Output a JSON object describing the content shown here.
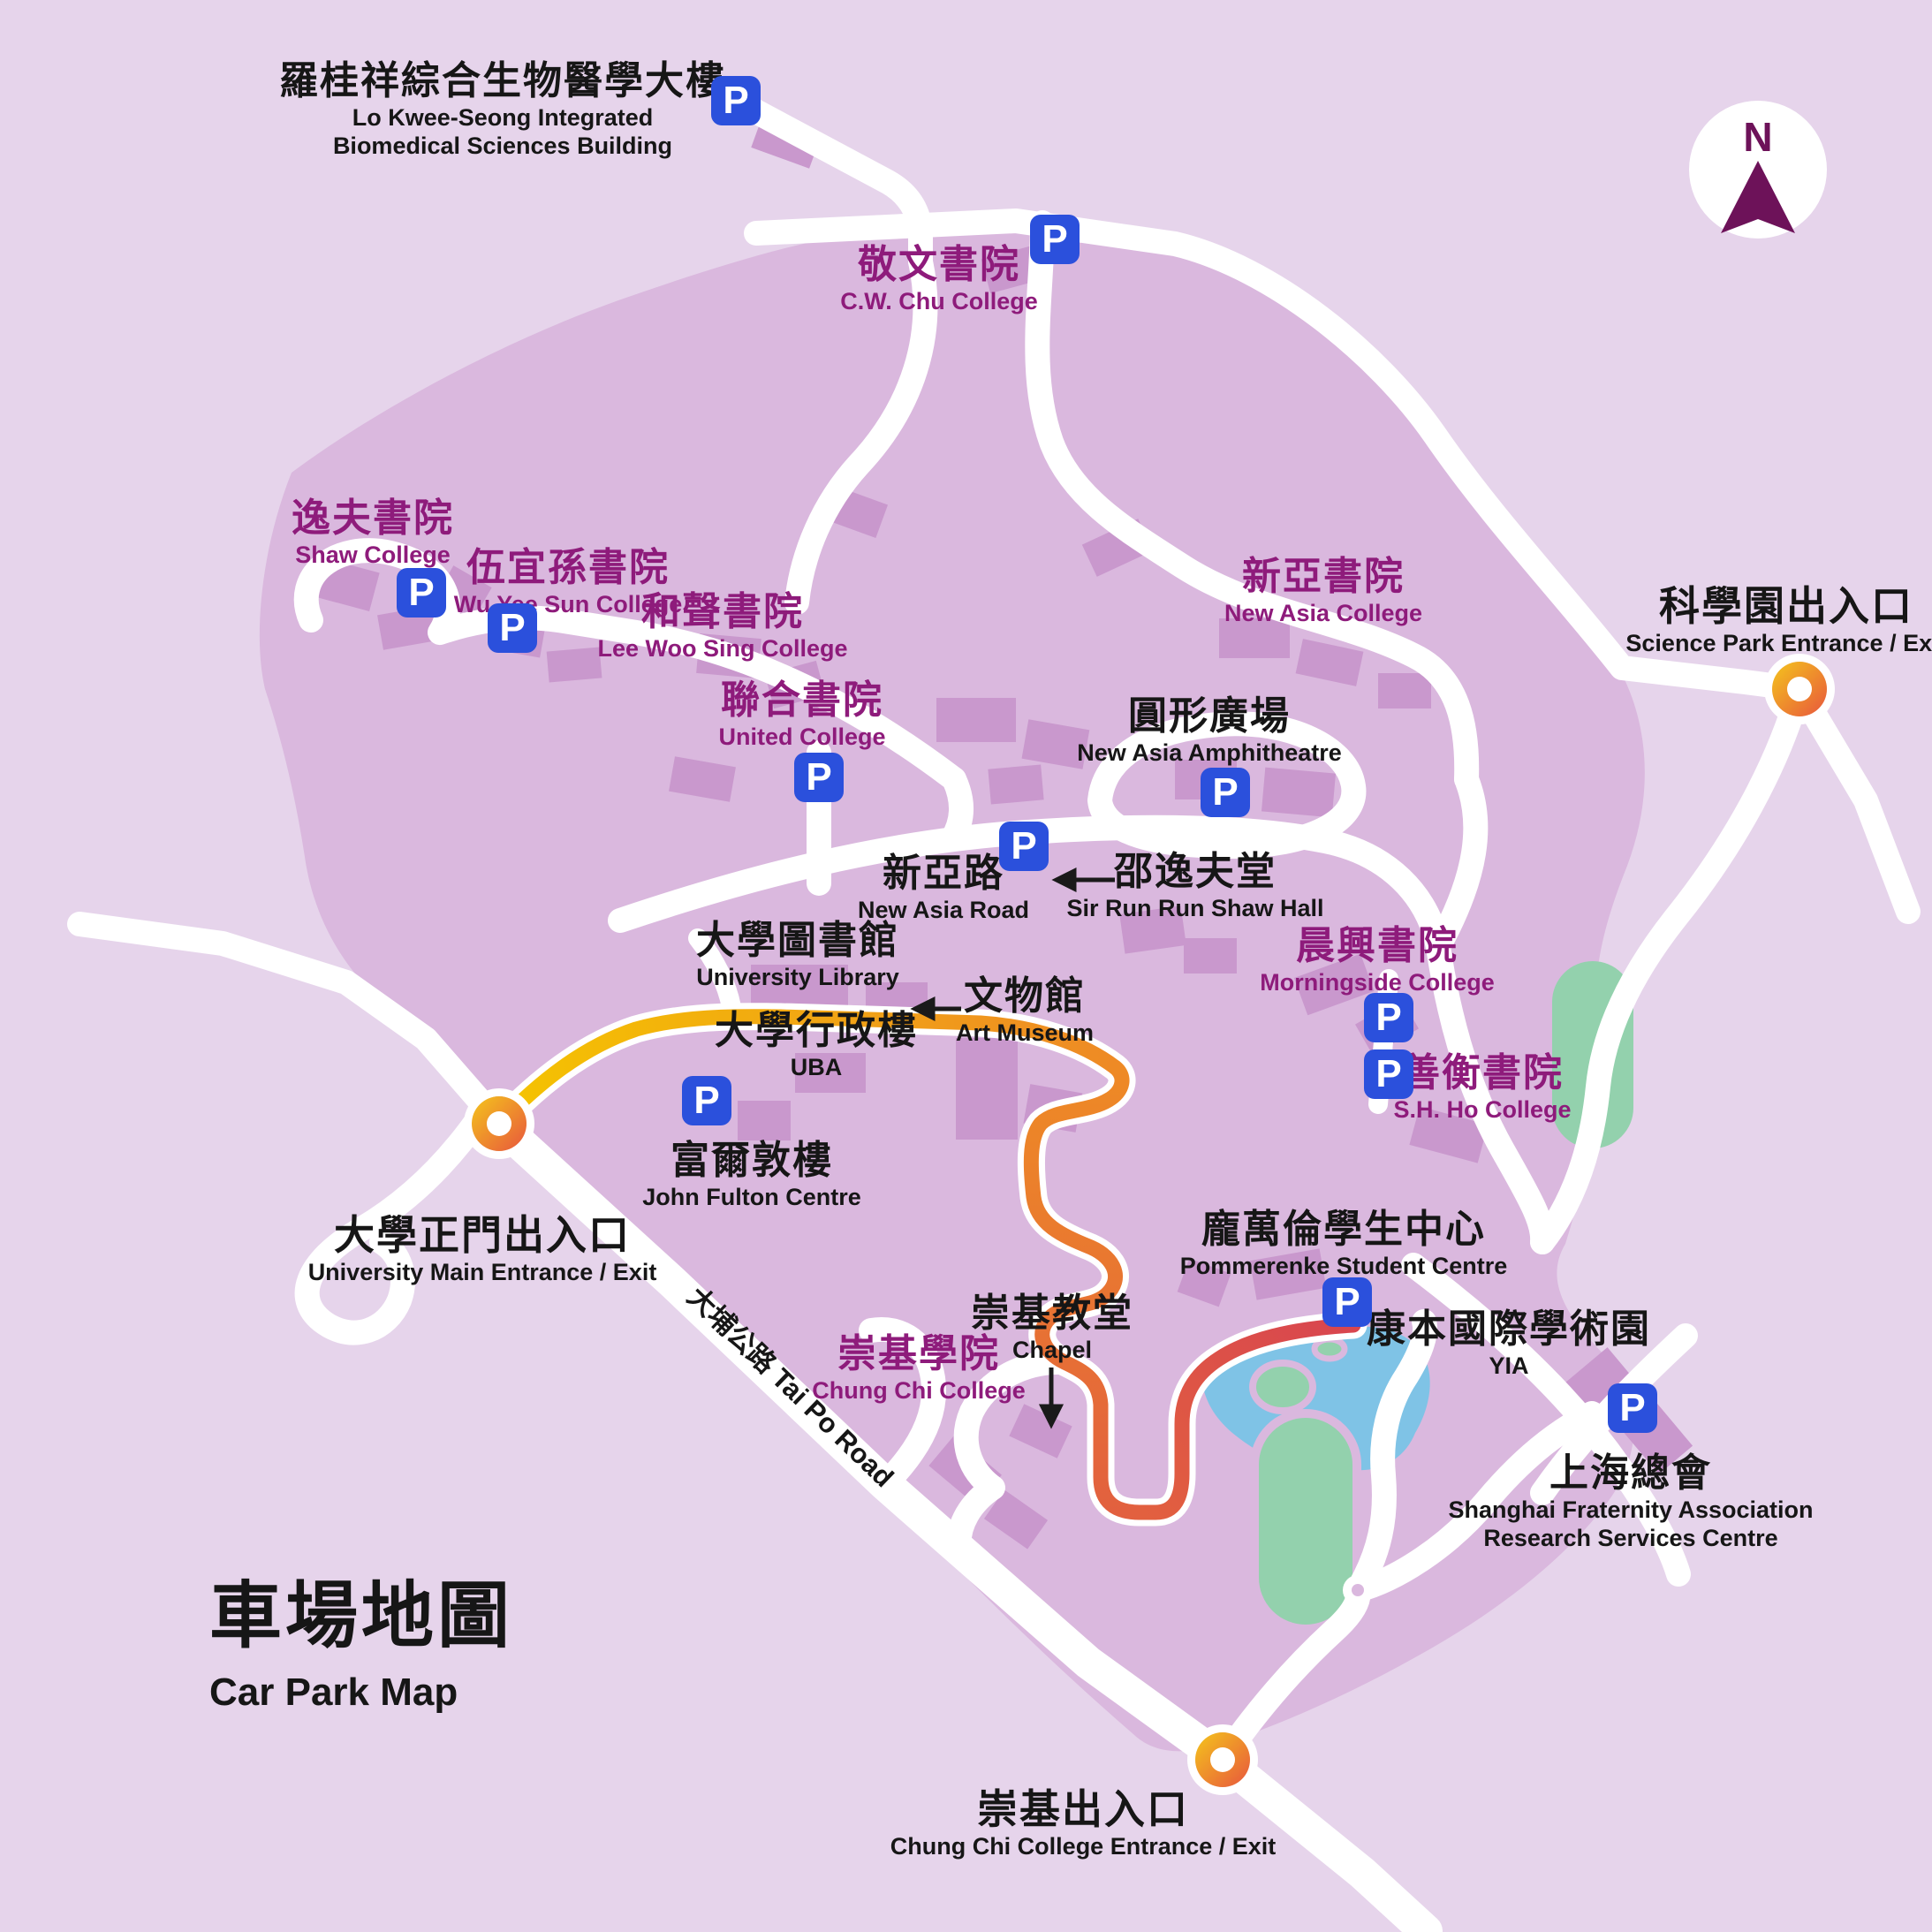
{
  "title": {
    "zh": "車場地圖",
    "en": "Car Park Map"
  },
  "compass": {
    "label": "N"
  },
  "parking": {
    "symbol": "P"
  },
  "colors": {
    "background": "#e6d4eb",
    "campus": "#dab8de",
    "building": "#c998cd",
    "road": "#ffffff",
    "college_text": "#8e1b7b",
    "black_text": "#161616",
    "parking_blue": "#2b50dc",
    "route_yellow": "#f5c400",
    "route_orange": "#ec7a2d",
    "route_red": "#d8454f",
    "lake_blue": "#7fc3e6",
    "field_green": "#93d1ad",
    "compass_purple": "#6d1259"
  },
  "locations": {
    "lo_kwee_seong": {
      "zh": "羅桂祥綜合生物醫學大樓",
      "en1": "Lo Kwee-Seong Integrated",
      "en2": "Biomedical Sciences Building"
    },
    "cw_chu": {
      "zh": "敬文書院",
      "en": "C.W. Chu College"
    },
    "shaw": {
      "zh": "逸夫書院",
      "en": "Shaw College"
    },
    "wu_yee_sun": {
      "zh": "伍宜孫書院",
      "en": "Wu Yee Sun College"
    },
    "lee_woo_sing": {
      "zh": "和聲書院",
      "en": "Lee Woo Sing College"
    },
    "united": {
      "zh": "聯合書院",
      "en": "United College"
    },
    "new_asia": {
      "zh": "新亞書院",
      "en": "New Asia College"
    },
    "amphitheatre": {
      "zh": "圓形廣場",
      "en": "New Asia Amphitheatre"
    },
    "new_asia_road": {
      "zh": "新亞路",
      "en": "New Asia Road"
    },
    "sir_run_run_shaw": {
      "zh": "邵逸夫堂",
      "en": "Sir Run Run Shaw Hall"
    },
    "library": {
      "zh": "大學圖書館",
      "en": "University Library"
    },
    "art_museum": {
      "zh": "文物館",
      "en": "Art Museum"
    },
    "uba": {
      "zh": "大學行政樓",
      "en": "UBA"
    },
    "morningside": {
      "zh": "晨興書院",
      "en": "Morningside College"
    },
    "sh_ho": {
      "zh": "善衡書院",
      "en": "S.H. Ho College"
    },
    "john_fulton": {
      "zh": "富爾敦樓",
      "en": "John Fulton Centre"
    },
    "pommerenke": {
      "zh": "龐萬倫學生中心",
      "en": "Pommerenke Student Centre"
    },
    "yia": {
      "zh": "康本國際學術園",
      "en": "YIA"
    },
    "chapel": {
      "zh": "崇基教堂",
      "en": "Chapel"
    },
    "chung_chi_college": {
      "zh": "崇基學院",
      "en": "Chung Chi College"
    },
    "shanghai": {
      "zh": "上海總會",
      "en1": "Shanghai Fraternity Association",
      "en2": "Research Services Centre"
    },
    "tai_po_road": {
      "label": "大埔公路 Tai Po Road"
    }
  },
  "entrances": {
    "main": {
      "zh": "大學正門出入口",
      "en": "University Main Entrance / Exit"
    },
    "science_park": {
      "zh": "科學園出入口",
      "en": "Science Park Entrance / Exit"
    },
    "chung_chi": {
      "zh": "崇基出入口",
      "en": "Chung Chi College Entrance / Exit"
    }
  }
}
